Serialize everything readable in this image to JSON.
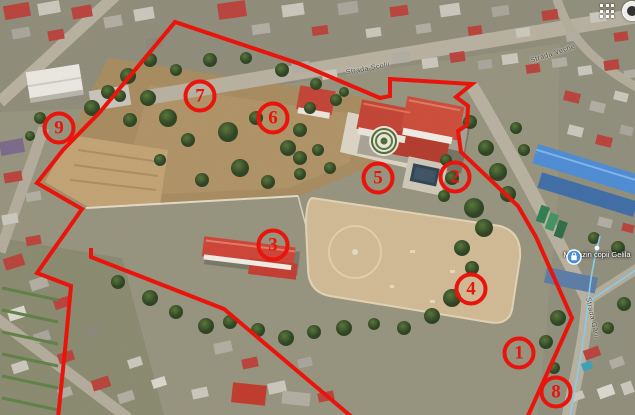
{
  "topbar": {
    "apps_icon": "apps-grid-icon",
    "avatar_icon": "account-avatar"
  },
  "map": {
    "poi": {
      "label": "Magazin copii Gelila",
      "pin_color": "#4a8fd4",
      "pin_icon": "shopping-bag-icon"
    },
    "street_labels": [
      {
        "text": "Strada Școlii",
        "x": 368,
        "y": 69,
        "rot": -10
      },
      {
        "text": "Strada Veche",
        "x": 553,
        "y": 54,
        "rot": -18
      },
      {
        "text": "Strada Gării",
        "x": 592,
        "y": 318,
        "rot": 78
      }
    ],
    "annotation": {
      "color": "#e9140c",
      "markers": [
        {
          "label": "1",
          "x": 519,
          "y": 353
        },
        {
          "label": "2",
          "x": 455,
          "y": 177
        },
        {
          "label": "3",
          "x": 273,
          "y": 245
        },
        {
          "label": "4",
          "x": 471,
          "y": 289
        },
        {
          "label": "5",
          "x": 378,
          "y": 178
        },
        {
          "label": "6",
          "x": 273,
          "y": 118
        },
        {
          "label": "7",
          "x": 200,
          "y": 96
        },
        {
          "label": "8",
          "x": 556,
          "y": 392
        },
        {
          "label": "9",
          "x": 59,
          "y": 128
        }
      ],
      "boundary_main": "58,418 65,350 71,286 37,273 82,209 37,183 63,150 100,112 175,22 300,64 380,98 390,96 390,79 472,84 456,97 468,106 467,125 458,131 461,152 518,206 536,237 572,318 527,418",
      "boundary_secondary": "91,248 91,257 224,309 353,418"
    }
  }
}
